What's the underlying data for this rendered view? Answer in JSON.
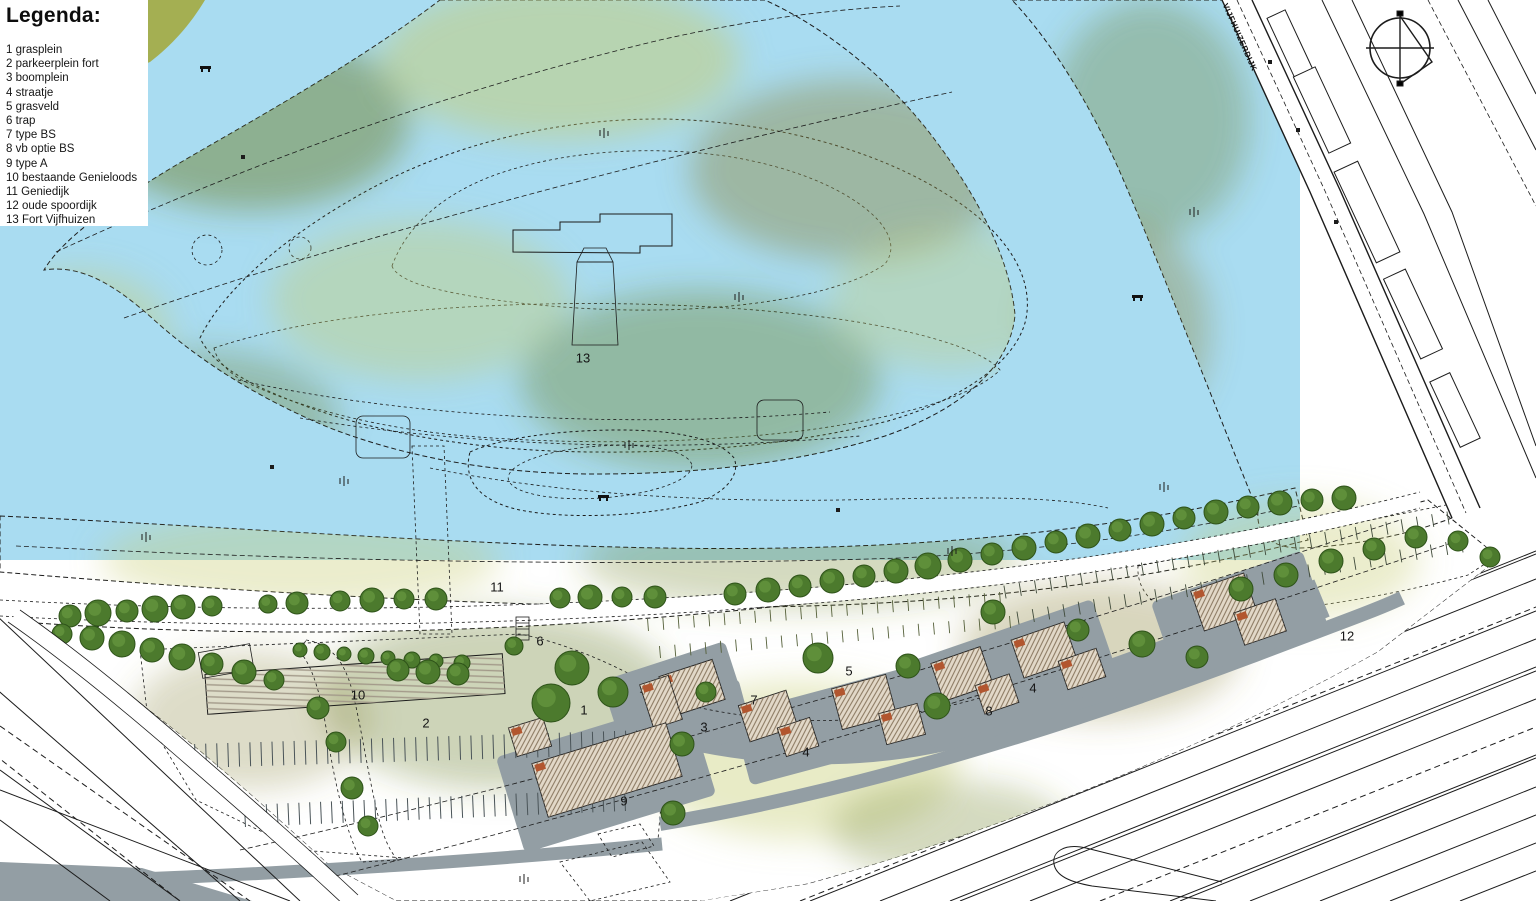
{
  "legend": {
    "title": "Legenda:",
    "items": [
      {
        "number": "1",
        "label": "grasplein"
      },
      {
        "number": "2",
        "label": "parkeerplein fort"
      },
      {
        "number": "3",
        "label": "boomplein"
      },
      {
        "number": "4",
        "label": "straatje"
      },
      {
        "number": "5",
        "label": "grasveld"
      },
      {
        "number": "6",
        "label": "trap"
      },
      {
        "number": "7",
        "label": "type BS"
      },
      {
        "number": "8",
        "label": "vb optie BS"
      },
      {
        "number": "9",
        "label": "type A"
      },
      {
        "number": "10",
        "label": "bestaande Genieloods"
      },
      {
        "number": "11",
        "label": "Geniedijk"
      },
      {
        "number": "12",
        "label": "oude spoordijk"
      },
      {
        "number": "13",
        "label": "Fort Vijfhuizen"
      }
    ]
  },
  "map": {
    "street_label": "VIJFHUIZERDIJK",
    "compass": "north-arrow",
    "labels": [
      {
        "text": "13",
        "x": 583,
        "y": 358
      },
      {
        "text": "11",
        "x": 497,
        "y": 587
      },
      {
        "text": "6",
        "x": 540,
        "y": 641
      },
      {
        "text": "10",
        "x": 358,
        "y": 695
      },
      {
        "text": "2",
        "x": 426,
        "y": 723
      },
      {
        "text": "1",
        "x": 584,
        "y": 710
      },
      {
        "text": "9",
        "x": 624,
        "y": 801
      },
      {
        "text": "3",
        "x": 704,
        "y": 727
      },
      {
        "text": "7",
        "x": 754,
        "y": 700
      },
      {
        "text": "4",
        "x": 806,
        "y": 752
      },
      {
        "text": "5",
        "x": 849,
        "y": 671
      },
      {
        "text": "8",
        "x": 989,
        "y": 711
      },
      {
        "text": "4",
        "x": 1033,
        "y": 688
      },
      {
        "text": "12",
        "x": 1347,
        "y": 636
      }
    ]
  },
  "colors": {
    "water": "#a9dcf1",
    "land_base": "#a4af52",
    "land_dark": "#6f8430",
    "land_light": "#c6cc71",
    "land_brown": "#8f8a44",
    "dike": "#a9b243",
    "path_gray": "#9aa1a7",
    "dark_gray": "#6b7075",
    "street_gray": "#939ea4",
    "tree_fill": "#4c7a2d",
    "tree_stroke": "#2e5319",
    "roof_fill": "#e2d8c8",
    "roof_ridge": "#b2562f",
    "line_black": "#1c1c1c"
  }
}
